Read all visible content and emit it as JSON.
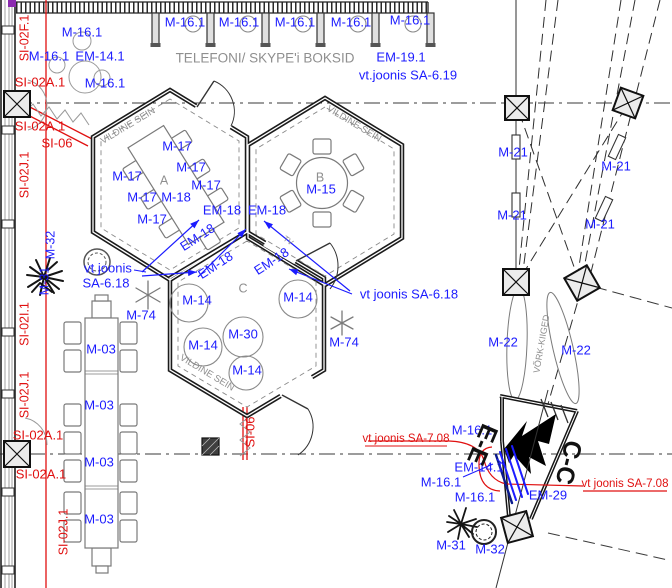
{
  "colors": {
    "blue": "#1c1cff",
    "red": "#e01010",
    "gray": "#8f8f8f",
    "black": "#111111"
  },
  "annotations": [
    {
      "n": "label-m16-topleft-1",
      "t": "M-16.1",
      "x": 82,
      "y": 33,
      "c": "blue",
      "s": 13
    },
    {
      "n": "label-m16-topleft-2",
      "t": "M-16.1",
      "x": 49,
      "y": 57,
      "c": "blue",
      "s": 13
    },
    {
      "n": "label-em14-topleft",
      "t": "EM-14.1",
      "x": 100,
      "y": 57,
      "c": "blue",
      "s": 13
    },
    {
      "n": "label-m16-topleft-3",
      "t": "M-16.1",
      "x": 105,
      "y": 84,
      "c": "blue",
      "s": 13
    },
    {
      "n": "label-booth-m16-1",
      "t": "M-16.1",
      "x": 185,
      "y": 23,
      "c": "blue",
      "s": 13
    },
    {
      "n": "label-booth-m16-2",
      "t": "M-16.1",
      "x": 239,
      "y": 23,
      "c": "blue",
      "s": 13
    },
    {
      "n": "label-booth-m16-3",
      "t": "M-16.1",
      "x": 295,
      "y": 23,
      "c": "blue",
      "s": 13
    },
    {
      "n": "label-booth-m16-4",
      "t": "M-16.1",
      "x": 351,
      "y": 23,
      "c": "blue",
      "s": 13
    },
    {
      "n": "label-booth-m16-5",
      "t": "M-16.1",
      "x": 410,
      "y": 21,
      "c": "blue",
      "s": 13
    },
    {
      "n": "label-em19",
      "t": "EM-19.1",
      "x": 401,
      "y": 58,
      "c": "blue",
      "s": 13
    },
    {
      "n": "label-vt-joonis-sa619",
      "t": "vt.joonis SA-6.19",
      "x": 408,
      "y": 76,
      "c": "blue",
      "s": 13
    },
    {
      "n": "label-m17-1",
      "t": "M-17",
      "x": 177,
      "y": 147,
      "c": "blue",
      "s": 13
    },
    {
      "n": "label-m17-2",
      "t": "M-17",
      "x": 191,
      "y": 168,
      "c": "blue",
      "s": 13
    },
    {
      "n": "label-m17-3",
      "t": "M-17",
      "x": 127,
      "y": 177,
      "c": "blue",
      "s": 13
    },
    {
      "n": "label-m17-4",
      "t": "M-17",
      "x": 206,
      "y": 186,
      "c": "blue",
      "s": 13
    },
    {
      "n": "label-m17-5",
      "t": "M-17",
      "x": 142,
      "y": 198,
      "c": "blue",
      "s": 13
    },
    {
      "n": "label-m17-6",
      "t": "M-17",
      "x": 152,
      "y": 220,
      "c": "blue",
      "s": 13
    },
    {
      "n": "label-m18",
      "t": "M-18",
      "x": 176,
      "y": 198,
      "c": "blue",
      "s": 13
    },
    {
      "n": "label-m15",
      "t": "M-15",
      "x": 321,
      "y": 190,
      "c": "blue",
      "s": 13
    },
    {
      "n": "label-em18-1",
      "t": "EM-18",
      "x": 222,
      "y": 211,
      "c": "blue",
      "s": 13
    },
    {
      "n": "label-em18-2",
      "t": "EM-18",
      "x": 267,
      "y": 211,
      "c": "blue",
      "s": 13
    },
    {
      "n": "label-em18-3",
      "t": "EM-18",
      "x": 198,
      "y": 238,
      "r": -33,
      "c": "blue",
      "s": 13
    },
    {
      "n": "label-em18-4",
      "t": "EM-18",
      "x": 216,
      "y": 266,
      "r": -33,
      "c": "blue",
      "s": 13
    },
    {
      "n": "label-em18-5",
      "t": "EM-18",
      "x": 272,
      "y": 262,
      "r": -33,
      "c": "blue",
      "s": 13
    },
    {
      "n": "label-vt-joonis-sa618-left-1",
      "t": "vt joonis",
      "x": 108,
      "y": 269,
      "c": "blue",
      "s": 13
    },
    {
      "n": "label-vt-joonis-sa618-left-2",
      "t": "SA-6.18",
      "x": 106,
      "y": 284,
      "c": "blue",
      "s": 13
    },
    {
      "n": "label-vt-joonis-sa618-right",
      "t": "vt joonis SA-6.18",
      "x": 409,
      "y": 295,
      "c": "blue",
      "s": 13
    },
    {
      "n": "label-m74-left",
      "t": "M-74",
      "x": 141,
      "y": 316,
      "c": "blue",
      "s": 13
    },
    {
      "n": "label-m74-right",
      "t": "M-74",
      "x": 344,
      "y": 343,
      "c": "blue",
      "s": 13
    },
    {
      "n": "label-m14-1",
      "t": "M-14",
      "x": 197,
      "y": 301,
      "c": "blue",
      "s": 13
    },
    {
      "n": "label-m14-2",
      "t": "M-14",
      "x": 298,
      "y": 298,
      "c": "blue",
      "s": 13
    },
    {
      "n": "label-m14-3",
      "t": "M-14",
      "x": 203,
      "y": 346,
      "c": "blue",
      "s": 13
    },
    {
      "n": "label-m14-4",
      "t": "M-14",
      "x": 247,
      "y": 371,
      "c": "blue",
      "s": 13
    },
    {
      "n": "label-m30",
      "t": "M-30",
      "x": 243,
      "y": 335,
      "c": "blue",
      "s": 13
    },
    {
      "n": "label-m03-1",
      "t": "M-03",
      "x": 101,
      "y": 350,
      "c": "blue",
      "s": 13
    },
    {
      "n": "label-m03-2",
      "t": "M-03",
      "x": 99,
      "y": 406,
      "c": "blue",
      "s": 13
    },
    {
      "n": "label-m03-3",
      "t": "M-03",
      "x": 99,
      "y": 463,
      "c": "blue",
      "s": 13
    },
    {
      "n": "label-m03-4",
      "t": "M-03",
      "x": 99,
      "y": 520,
      "c": "blue",
      "s": 13
    },
    {
      "n": "label-m32-left",
      "t": "M-32",
      "x": 51,
      "y": 245,
      "r": -90,
      "c": "blue",
      "s": 12.5
    },
    {
      "n": "label-m31-left",
      "t": "M-31",
      "x": 45,
      "y": 281,
      "r": -90,
      "c": "blue",
      "s": 12.5
    },
    {
      "n": "label-m21-1",
      "t": "M-21",
      "x": 513,
      "y": 153,
      "c": "blue",
      "s": 13
    },
    {
      "n": "label-m21-2",
      "t": "M-21",
      "x": 616,
      "y": 167,
      "c": "blue",
      "s": 13
    },
    {
      "n": "label-m21-3",
      "t": "M-21",
      "x": 512,
      "y": 216,
      "c": "blue",
      "s": 13
    },
    {
      "n": "label-m21-4",
      "t": "M-21",
      "x": 600,
      "y": 225,
      "c": "blue",
      "s": 13
    },
    {
      "n": "label-m22-1",
      "t": "M-22",
      "x": 503,
      "y": 343,
      "c": "blue",
      "s": 13
    },
    {
      "n": "label-m22-2",
      "t": "M-22",
      "x": 576,
      "y": 351,
      "c": "blue",
      "s": 13
    },
    {
      "n": "label-m16-br-1",
      "t": "M-16.1",
      "x": 472,
      "y": 431,
      "c": "blue",
      "s": 13
    },
    {
      "n": "label-em14-br",
      "t": "EM-14.1",
      "x": 479,
      "y": 468,
      "c": "blue",
      "s": 13
    },
    {
      "n": "label-m16-br-2",
      "t": "M-16.1",
      "x": 441,
      "y": 483,
      "c": "blue",
      "s": 13
    },
    {
      "n": "label-m16-br-3",
      "t": "M-16.1",
      "x": 475,
      "y": 498,
      "c": "blue",
      "s": 13
    },
    {
      "n": "label-em29",
      "t": "EM-29",
      "x": 548,
      "y": 496,
      "c": "blue",
      "s": 13
    },
    {
      "n": "label-m31-br",
      "t": "M-31",
      "x": 451,
      "y": 546,
      "c": "blue",
      "s": 13
    },
    {
      "n": "label-m32-br",
      "t": "M-32",
      "x": 490,
      "y": 550,
      "c": "blue",
      "s": 13
    },
    {
      "n": "label-si02f",
      "t": "SI-02F.1",
      "x": 25,
      "y": 38,
      "r": -90,
      "c": "red",
      "s": 12.5
    },
    {
      "n": "label-si02a-1",
      "t": "SI-02A.1",
      "x": 40,
      "y": 83,
      "c": "red",
      "s": 13
    },
    {
      "n": "label-si02a-2",
      "t": "SI-02A.1",
      "x": 40,
      "y": 127,
      "c": "red",
      "s": 13
    },
    {
      "n": "label-si06-top",
      "t": "SI-06",
      "x": 57,
      "y": 144,
      "c": "red",
      "s": 13
    },
    {
      "n": "label-si02j-1",
      "t": "SI-02J.1",
      "x": 25,
      "y": 175,
      "r": -90,
      "c": "red",
      "s": 12.5
    },
    {
      "n": "label-si02i",
      "t": "SI-02I.1",
      "x": 25,
      "y": 324,
      "r": -90,
      "c": "red",
      "s": 12.5
    },
    {
      "n": "label-si02j-2",
      "t": "SI-02J.1",
      "x": 25,
      "y": 395,
      "r": -90,
      "c": "red",
      "s": 12.5
    },
    {
      "n": "label-si02a-3",
      "t": "SI-02A.1",
      "x": 38,
      "y": 436,
      "c": "red",
      "s": 13
    },
    {
      "n": "label-si02a-4",
      "t": "SI-02A.1",
      "x": 41,
      "y": 475,
      "c": "red",
      "s": 13
    },
    {
      "n": "label-si02j-3",
      "t": "SI-02J.1",
      "x": 64,
      "y": 532,
      "r": -90,
      "c": "red",
      "s": 12.5
    },
    {
      "n": "label-si06-vertical",
      "t": "SI-06",
      "x": 251,
      "y": 432,
      "r": -90,
      "c": "red",
      "s": 13
    },
    {
      "n": "label-vt-joonis-sa708-left",
      "t": "vt joonis SA-7.08",
      "x": 406,
      "y": 439,
      "c": "red",
      "s": 11.5
    },
    {
      "n": "label-vt-joonis-sa708-right",
      "t": "vt joonis SA-7.08",
      "x": 625,
      "y": 484,
      "c": "red",
      "s": 11.5
    },
    {
      "n": "label-booth-caption",
      "t": "TELEFONI/ SKYPE'i BOKSID",
      "x": 265,
      "y": 59,
      "c": "gray",
      "s": 13.5
    },
    {
      "n": "label-vildine-sein-a",
      "t": "VILDINE SEIN",
      "x": 128,
      "y": 126,
      "r": -31,
      "c": "gray",
      "s": 9.5
    },
    {
      "n": "label-vildine-sein-b",
      "t": "VILDINE SEIN",
      "x": 354,
      "y": 124,
      "r": 31,
      "c": "gray",
      "s": 9.5
    },
    {
      "n": "label-vildine-sein-c",
      "t": "VILDINE SEIN",
      "x": 207,
      "y": 373,
      "r": 31,
      "c": "gray",
      "s": 9.5
    },
    {
      "n": "label-vork-kiiged",
      "t": "VÕRK-KIIGED",
      "x": 542,
      "y": 344,
      "r": -80,
      "c": "gray",
      "s": 9
    },
    {
      "n": "label-room-a",
      "t": "A",
      "x": 164,
      "y": 181,
      "c": "gray",
      "s": 12.5
    },
    {
      "n": "label-room-b",
      "t": "B",
      "x": 320,
      "y": 178,
      "c": "gray",
      "s": 12.5
    },
    {
      "n": "label-room-c",
      "t": "C",
      "x": 243,
      "y": 289,
      "c": "gray",
      "s": 12.5
    },
    {
      "n": "label-tv",
      "t": "TV",
      "x": 288,
      "y": 241,
      "r": 35,
      "c": "gray",
      "s": 8
    },
    {
      "n": "label-section-ee",
      "t": "E-E",
      "x": 481,
      "y": 444,
      "r": 113,
      "c": "black",
      "s": 25,
      "w": "bold"
    },
    {
      "n": "label-section-cc",
      "t": "C-C",
      "x": 567,
      "y": 462,
      "r": 104,
      "c": "black",
      "s": 25,
      "w": "bold"
    }
  ],
  "arrows": [
    {
      "x1": 142,
      "y1": 272,
      "x2": 199,
      "y2": 220
    },
    {
      "x1": 142,
      "y1": 276,
      "x2": 197,
      "y2": 272
    },
    {
      "x1": 198,
      "y1": 277,
      "x2": 246,
      "y2": 229
    },
    {
      "x1": 350,
      "y1": 291,
      "x2": 264,
      "y2": 221
    },
    {
      "x1": 352,
      "y1": 294,
      "x2": 289,
      "y2": 269
    }
  ],
  "leaders": [
    {
      "x1": 134,
      "y1": 270,
      "x2": 146,
      "y2": 272
    },
    {
      "x1": 506,
      "y1": 467,
      "x2": 497,
      "y2": 459
    },
    {
      "x1": 463,
      "y1": 477,
      "x2": 493,
      "y2": 464
    }
  ]
}
